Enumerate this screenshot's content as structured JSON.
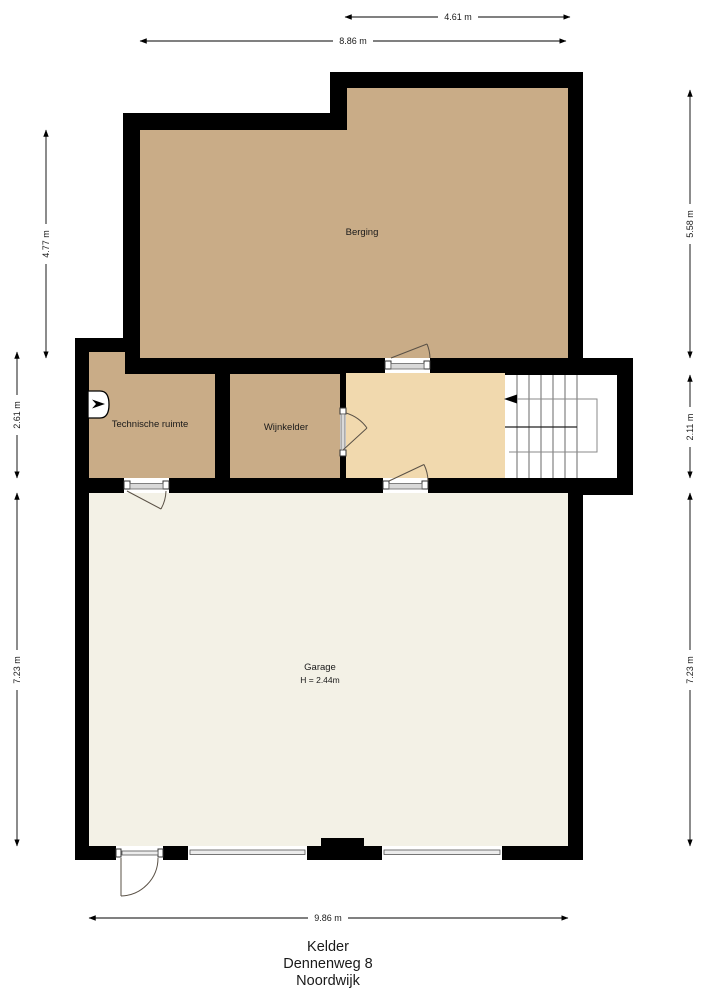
{
  "plan": {
    "floor_name": "Kelder",
    "address_line": "Dennenweg 8",
    "city_line": "Noordwijk"
  },
  "rooms": {
    "berging": {
      "label": "Berging"
    },
    "technische_ruimte": {
      "label": "Technische ruimte"
    },
    "wijnkelder": {
      "label": "Wijnkelder"
    },
    "garage": {
      "label": "Garage",
      "height_note": "H = 2.44m"
    },
    "trap": {
      "label": "stairs"
    }
  },
  "dimensions": {
    "top_inner": "4.61 m",
    "top_outer": "8.86 m",
    "left_upper": "4.77 m",
    "left_middle": "2.61 m",
    "left_lower": "7.23 m",
    "right_upper": "5.58 m",
    "right_middle": "2.11 m",
    "right_lower": "7.23 m",
    "bottom": "9.86 m"
  },
  "colors": {
    "wall": "#000000",
    "room_floor": "#c9ac87",
    "hall_floor": "#f1d9ae",
    "stairs_floor": "#ffffff",
    "garage_floor": "#f3f1e6",
    "background": "#ffffff"
  }
}
